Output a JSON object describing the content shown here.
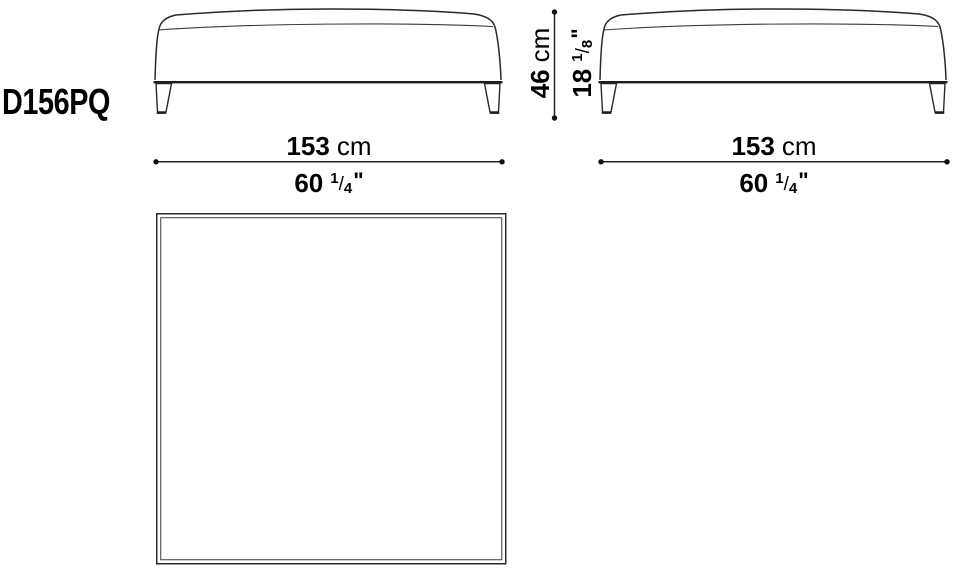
{
  "product_code": "D156PQ",
  "dimensions": {
    "width_front": {
      "metric": "153",
      "metric_unit": "cm",
      "imp_whole": "60",
      "imp_num": "1",
      "imp_den": "4",
      "imp_unit": "\""
    },
    "width_side": {
      "metric": "153",
      "metric_unit": "cm",
      "imp_whole": "60",
      "imp_num": "1",
      "imp_den": "4",
      "imp_unit": "\""
    },
    "height": {
      "metric": "46",
      "metric_unit": "cm",
      "imp_whole": "18",
      "imp_num": "1",
      "imp_den": "8",
      "imp_unit": "\""
    }
  },
  "colors": {
    "background": "#ffffff",
    "outline": "#2a2a2a",
    "seam": "#3c3c3c",
    "base_line": "#1e1e1e",
    "dimension_line": "#222222",
    "text": "#000000"
  }
}
